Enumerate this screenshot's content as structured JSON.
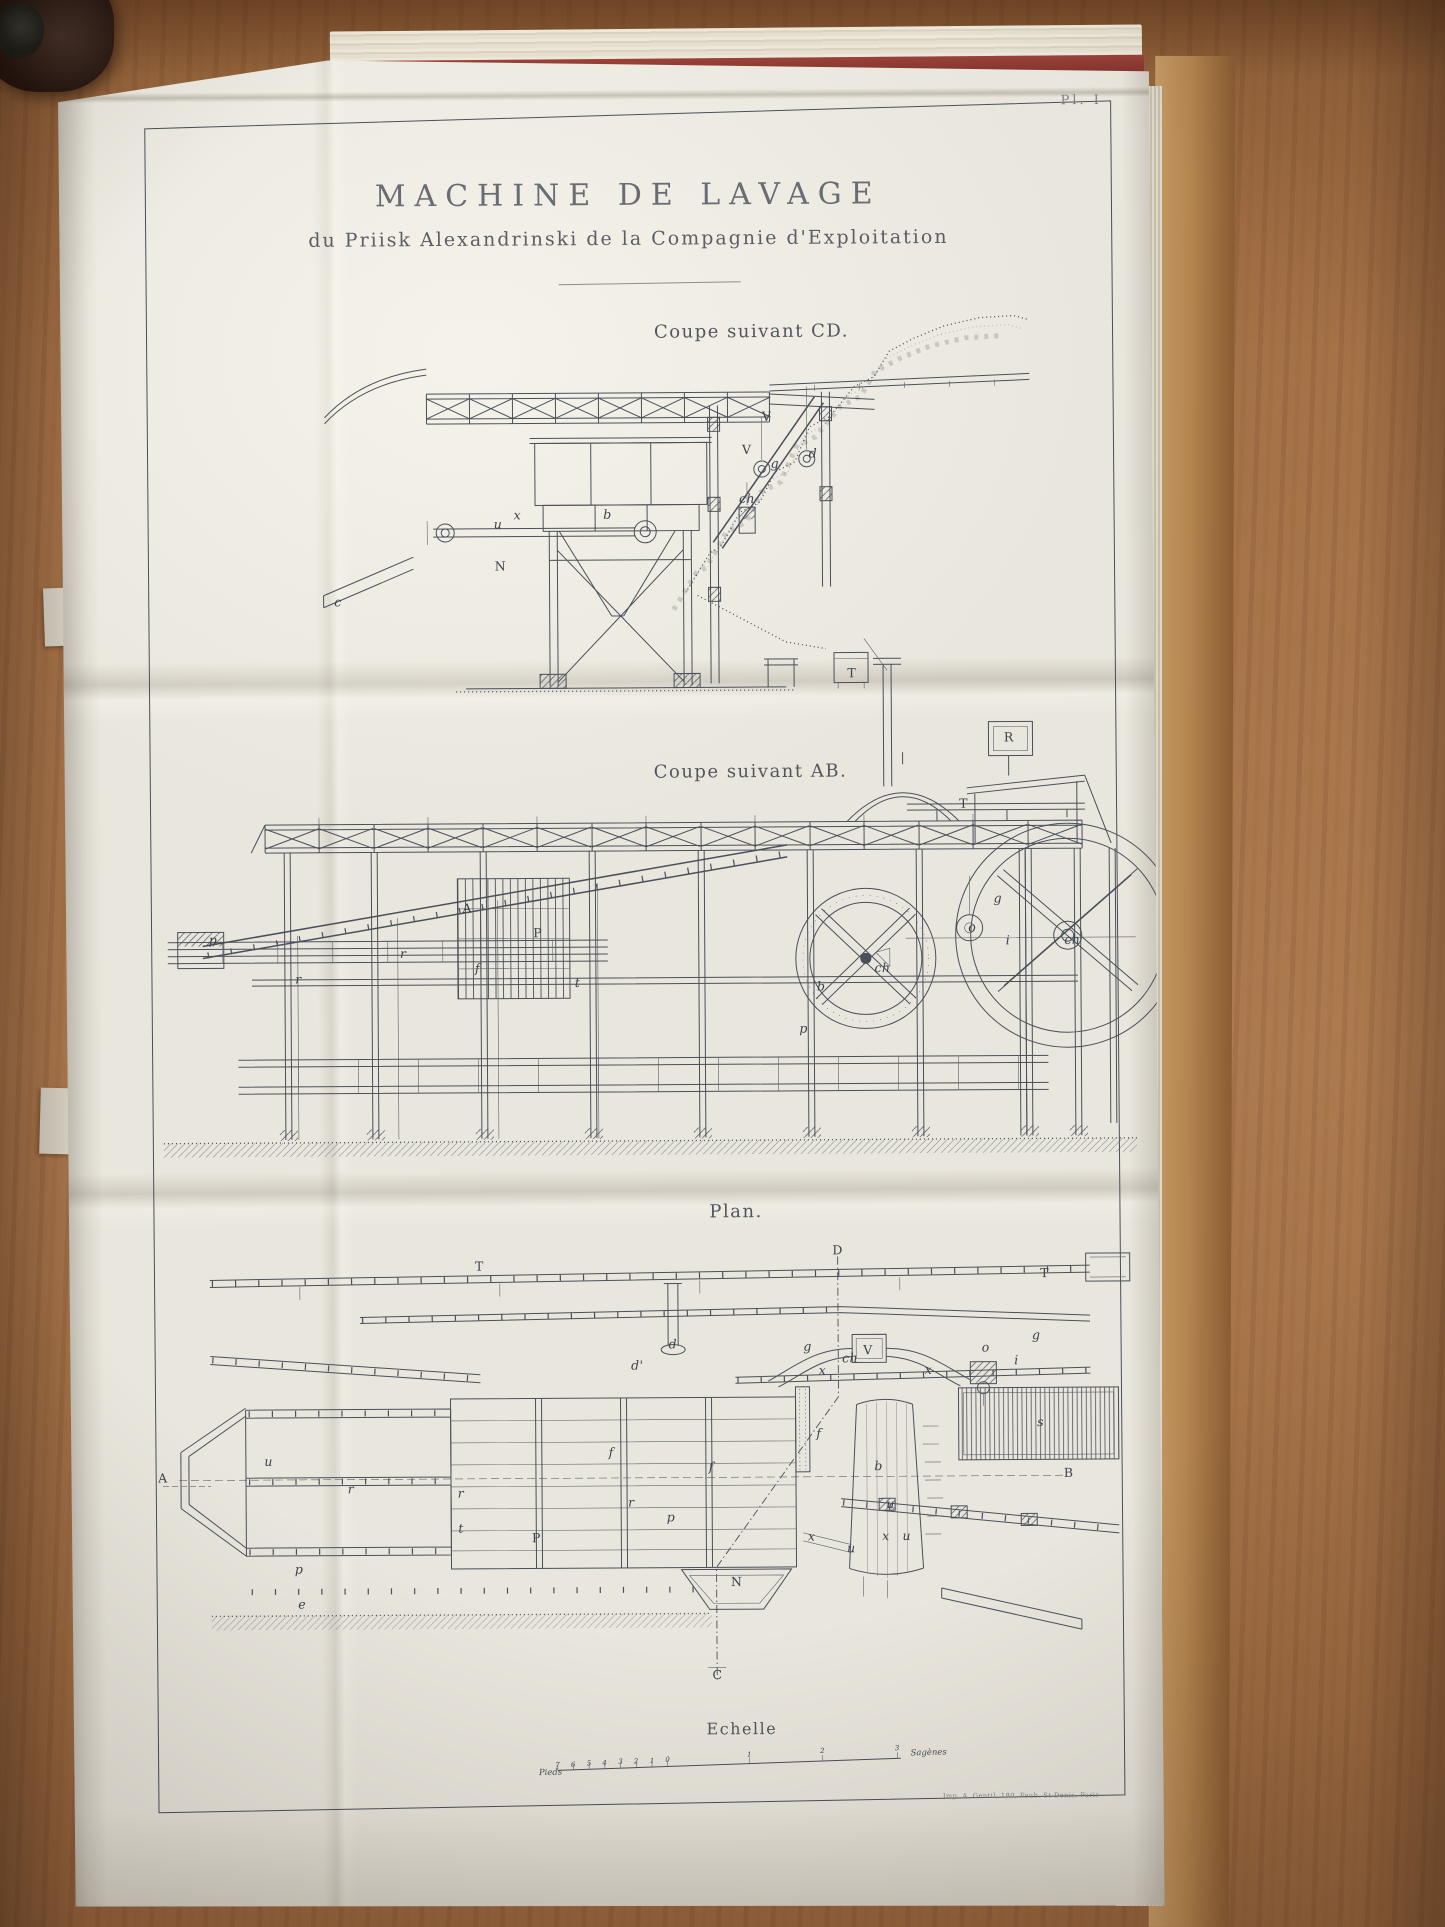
{
  "plate": {
    "number": "Pl. I",
    "title": "MACHINE DE LAVAGE",
    "subtitle": "du Priisk Alexandrinski de la Compagnie d'Exploitation",
    "imprint": "Imp. A. Gentil, 180, Faub. St Denis, Paris",
    "ink_color": "#49505a",
    "paper_color": "#e9e6dd",
    "desk_wood_color": "#a5714a",
    "book_cover_color": "#8e3a33"
  },
  "views": [
    {
      "id": "coupe-cd",
      "caption": "Coupe suivant CD.",
      "labels": [
        {
          "t": "V",
          "x": 62.8,
          "y": 29.3
        },
        {
          "t": "V",
          "x": 60.0,
          "y": 37.3
        },
        {
          "t": "g",
          "x": 63.9,
          "y": 40.7
        },
        {
          "t": "d",
          "x": 69.2,
          "y": 38.3
        },
        {
          "t": "ch",
          "x": 60.0,
          "y": 49.3
        },
        {
          "t": "b",
          "x": 40.6,
          "y": 52.9
        },
        {
          "t": "x",
          "x": 28.1,
          "y": 52.9
        },
        {
          "t": "u",
          "x": 25.4,
          "y": 55.1
        },
        {
          "t": "N",
          "x": 25.7,
          "y": 65.4
        },
        {
          "t": "c",
          "x": 3.1,
          "y": 73.9
        },
        {
          "t": "T",
          "x": 74.4,
          "y": 92.0
        }
      ]
    },
    {
      "id": "coupe-ab",
      "caption": "Coupe suivant AB.",
      "labels": [
        {
          "t": "R",
          "x": 87.1,
          "y": 18.5
        },
        {
          "t": "T",
          "x": 82.5,
          "y": 30.5
        },
        {
          "t": "g",
          "x": 85.9,
          "y": 47.8
        },
        {
          "t": "o",
          "x": 83.3,
          "y": 53.1
        },
        {
          "t": "i",
          "x": 86.9,
          "y": 55.5
        },
        {
          "t": "ch",
          "x": 74.2,
          "y": 60.4
        },
        {
          "t": "ch",
          "x": 93.4,
          "y": 55.5
        },
        {
          "t": "b",
          "x": 68.0,
          "y": 63.6
        },
        {
          "t": "p",
          "x": 66.2,
          "y": 71.3
        },
        {
          "t": "A",
          "x": 32.3,
          "y": 49.1
        },
        {
          "t": "P",
          "x": 39.4,
          "y": 53.6
        },
        {
          "t": "r",
          "x": 25.8,
          "y": 57.3
        },
        {
          "t": "r",
          "x": 15.2,
          "y": 61.8
        },
        {
          "t": "f",
          "x": 33.3,
          "y": 60.0
        },
        {
          "t": "t",
          "x": 43.4,
          "y": 62.7
        },
        {
          "t": "p",
          "x": 6.6,
          "y": 54.5
        }
      ]
    },
    {
      "id": "plan",
      "caption": "Plan.",
      "labels": [
        {
          "t": "T",
          "x": 33.3,
          "y": 6.0
        },
        {
          "t": "D",
          "x": 69.5,
          "y": 3.0
        },
        {
          "t": "T",
          "x": 90.4,
          "y": 8.1
        },
        {
          "t": "d",
          "x": 52.8,
          "y": 22.8
        },
        {
          "t": "d'",
          "x": 49.2,
          "y": 27.2
        },
        {
          "t": "g",
          "x": 66.4,
          "y": 23.4
        },
        {
          "t": "ch",
          "x": 70.7,
          "y": 26.0
        },
        {
          "t": "V",
          "x": 72.5,
          "y": 24.3
        },
        {
          "t": "x",
          "x": 67.9,
          "y": 28.5
        },
        {
          "t": "x",
          "x": 78.6,
          "y": 28.5
        },
        {
          "t": "o",
          "x": 84.4,
          "y": 23.8
        },
        {
          "t": "i",
          "x": 87.5,
          "y": 26.6
        },
        {
          "t": "g",
          "x": 89.5,
          "y": 21.3
        },
        {
          "t": "s",
          "x": 89.9,
          "y": 39.8
        },
        {
          "t": "b",
          "x": 73.5,
          "y": 48.9
        },
        {
          "t": "f",
          "x": 67.5,
          "y": 41.9
        },
        {
          "t": "f",
          "x": 56.6,
          "y": 48.9
        },
        {
          "t": "f",
          "x": 46.5,
          "y": 45.7
        },
        {
          "t": "r",
          "x": 20.2,
          "y": 53.2
        },
        {
          "t": "r",
          "x": 31.3,
          "y": 54.3
        },
        {
          "t": "r",
          "x": 48.5,
          "y": 56.4
        },
        {
          "t": "t",
          "x": 31.3,
          "y": 61.7
        },
        {
          "t": "P",
          "x": 38.9,
          "y": 63.8
        },
        {
          "t": "p",
          "x": 14.9,
          "y": 70.2
        },
        {
          "t": "p",
          "x": 52.5,
          "y": 59.6
        },
        {
          "t": "u",
          "x": 11.9,
          "y": 47.2
        },
        {
          "t": "u",
          "x": 70.7,
          "y": 66.4
        },
        {
          "t": "u",
          "x": 76.3,
          "y": 63.8
        },
        {
          "t": "x",
          "x": 66.7,
          "y": 63.8
        },
        {
          "t": "x",
          "x": 74.2,
          "y": 63.8
        },
        {
          "t": "N",
          "x": 59.1,
          "y": 73.4
        },
        {
          "t": "C",
          "x": 57.1,
          "y": 93.2
        },
        {
          "t": "A",
          "x": 1.2,
          "y": 50.6
        },
        {
          "t": "B",
          "x": 92.7,
          "y": 50.6
        },
        {
          "t": "e",
          "x": 15.2,
          "y": 77.7
        },
        {
          "t": "u",
          "x": 74.7,
          "y": 57.0
        }
      ]
    }
  ],
  "scale": {
    "caption": "Echelle",
    "unit_left": "Pieds",
    "unit_right": "Sagènes",
    "subdivisions": [
      {
        "t": "7",
        "x": 3.6,
        "y": 46
      },
      {
        "t": "6",
        "x": 7.3,
        "y": 45
      },
      {
        "t": "5",
        "x": 11.1,
        "y": 44
      },
      {
        "t": "4",
        "x": 14.8,
        "y": 43
      },
      {
        "t": "3",
        "x": 18.6,
        "y": 42
      },
      {
        "t": "2",
        "x": 22.3,
        "y": 41
      },
      {
        "t": "1",
        "x": 26.1,
        "y": 40
      },
      {
        "t": "0",
        "x": 29.8,
        "y": 39
      }
    ],
    "divisions": [
      {
        "t": "1",
        "x": 49.3,
        "y": 32
      },
      {
        "t": "2",
        "x": 66.7,
        "y": 28
      },
      {
        "t": "3",
        "x": 84.5,
        "y": 24
      }
    ]
  }
}
